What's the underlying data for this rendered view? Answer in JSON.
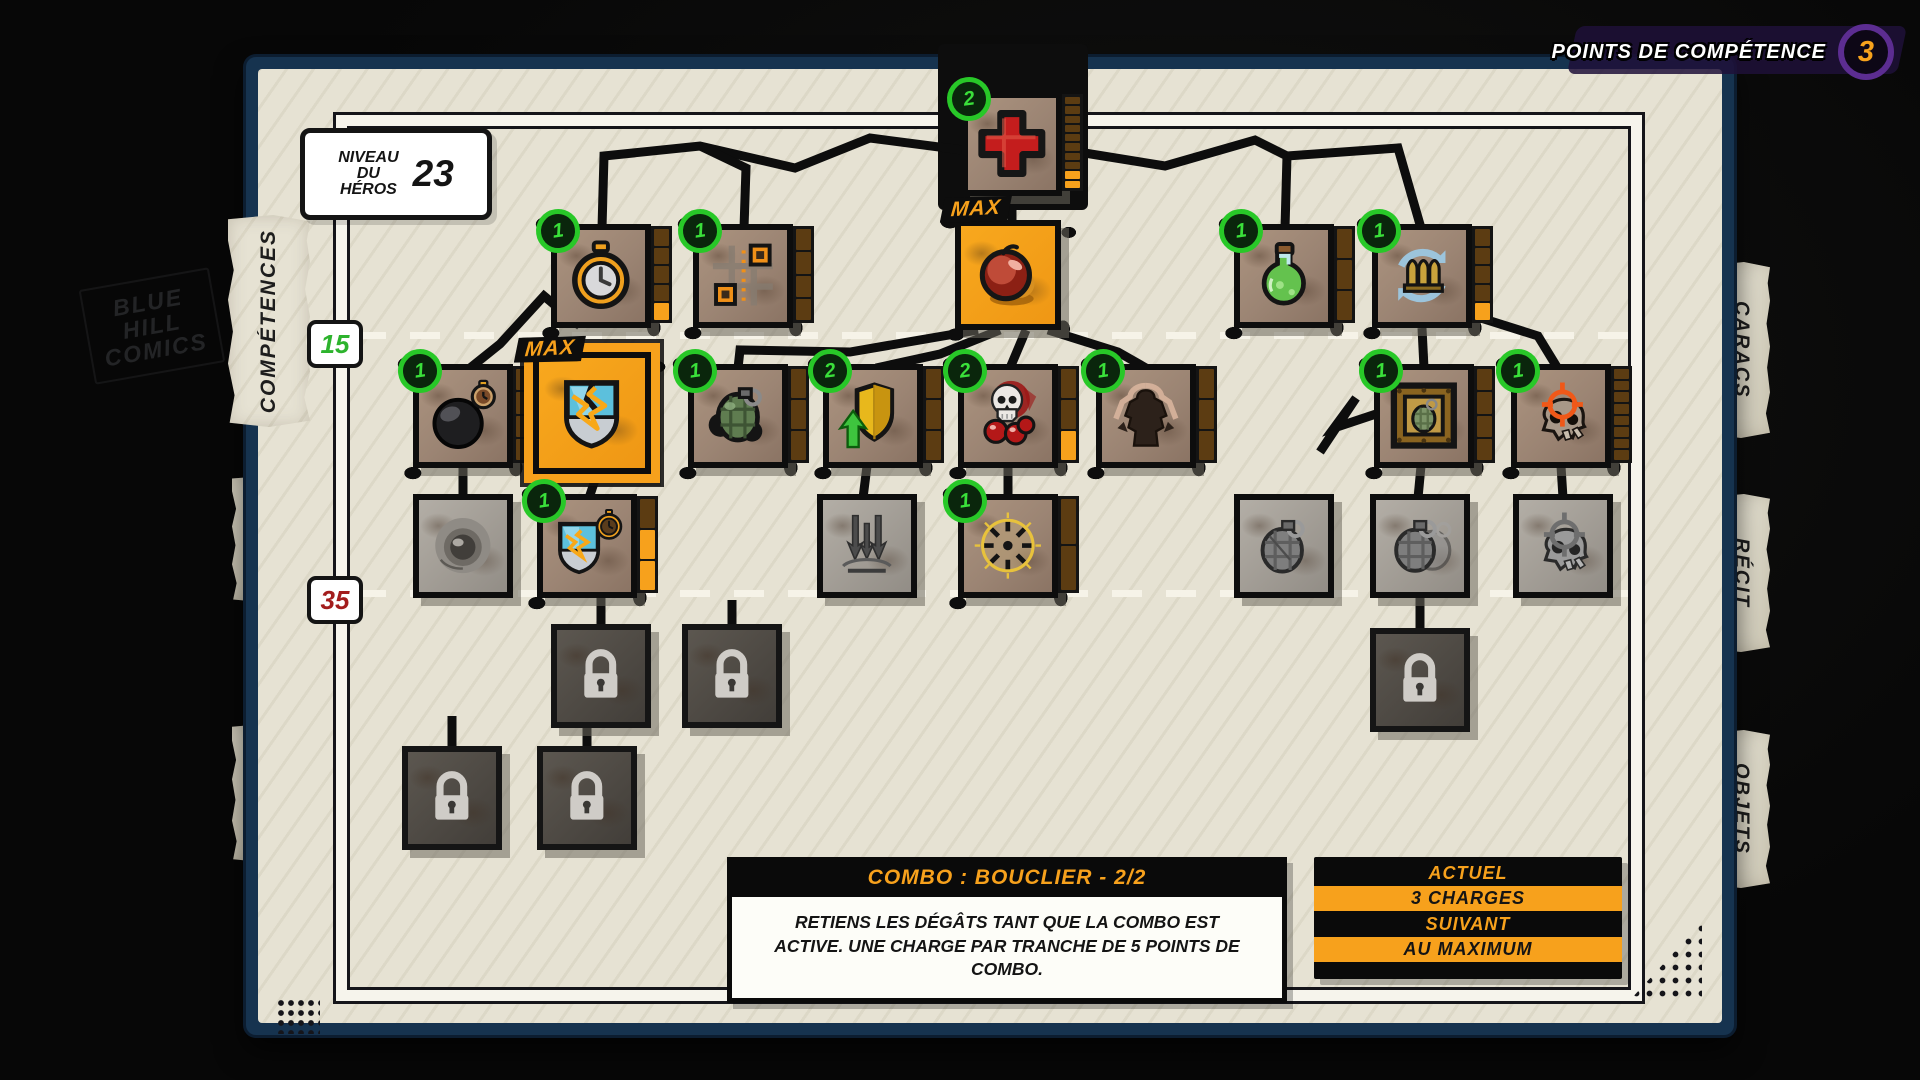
{
  "header": {
    "skill_points_label": "POINTS DE COMPÉTENCE",
    "skill_points_value": "3"
  },
  "hero_level": {
    "lines": [
      "NIVEAU",
      "DU",
      "HÉROS"
    ],
    "value": "23"
  },
  "background": {
    "logo_lines": [
      "BLUE",
      "HILL",
      "COMICS"
    ]
  },
  "labels": {
    "max": "MAX"
  },
  "tabs_left": [
    {
      "id": "competences",
      "label": "COMPÉTENCES",
      "active": true,
      "top": 215,
      "height": 212
    },
    {
      "id": "aspect",
      "label": "ASPECT",
      "active": false,
      "top": 476,
      "height": 126
    },
    {
      "id": "matos",
      "label": "MATOS",
      "active": false,
      "top": 724,
      "height": 138
    }
  ],
  "tabs_right": [
    {
      "id": "caracs",
      "label": "CARACS",
      "top": 262,
      "height": 176
    },
    {
      "id": "recit",
      "label": "RÉCIT",
      "top": 494,
      "height": 158
    },
    {
      "id": "objets",
      "label": "OBJETS",
      "top": 730,
      "height": 158
    }
  ],
  "level_markers": [
    {
      "value": "15",
      "color": "#2db32d",
      "line_y": 332,
      "box_y": 340
    },
    {
      "value": "35",
      "color": "#a31d1d",
      "line_y": 590,
      "box_y": 596
    }
  ],
  "tooltip": {
    "title": "COMBO : BOUCLIER - 2/2",
    "body": "RETIENS LES DÉGÂTS TANT QUE LA COMBO EST ACTIVE. UNE CHARGE PAR TRANCHE DE 5 POINTS DE COMBO."
  },
  "status_panel": {
    "rows": [
      {
        "text": "ACTUEL",
        "variant": "header"
      },
      {
        "text": "3 CHARGES",
        "variant": "value"
      },
      {
        "text": "SUIVANT",
        "variant": "header"
      },
      {
        "text": "AU MAXIMUM",
        "variant": "value"
      }
    ]
  },
  "colors": {
    "accent_orange": "#f7a11c",
    "badge_green": "#3ae03a",
    "points_purple": "#5c2d91",
    "panel_blue": "#16334f",
    "paper": "#e6e2d3"
  },
  "tree": {
    "nodes": [
      {
        "id": "heal",
        "icon": "heal-cross",
        "x": 962,
        "y": 92,
        "size": 100,
        "badge": "2",
        "strip": [
          10,
          2
        ]
      },
      {
        "id": "stopwatch",
        "icon": "stopwatch",
        "x": 551,
        "y": 224,
        "size": 100,
        "badge": "1",
        "strip": [
          5,
          1
        ]
      },
      {
        "id": "waypoint",
        "icon": "waypoint-path",
        "x": 693,
        "y": 224,
        "size": 100,
        "badge": "1",
        "strip": [
          4,
          0
        ]
      },
      {
        "id": "bomb-max",
        "icon": "bomb-red",
        "x": 955,
        "y": 220,
        "size": 106,
        "max": true
      },
      {
        "id": "potion",
        "icon": "potion",
        "x": 1234,
        "y": 224,
        "size": 100,
        "badge": "1",
        "strip": [
          3,
          0
        ]
      },
      {
        "id": "reload",
        "icon": "reload",
        "x": 1372,
        "y": 224,
        "size": 100,
        "badge": "1",
        "strip": [
          5,
          1
        ]
      },
      {
        "id": "black-bomb",
        "icon": "black-bomb",
        "x": 413,
        "y": 364,
        "size": 100,
        "badge": "1",
        "strip": [
          4,
          0
        ]
      },
      {
        "id": "shield-combo",
        "icon": "shield-combo",
        "x": 533,
        "y": 352,
        "size": 118,
        "max": true,
        "selected": true
      },
      {
        "id": "grenade",
        "icon": "grenade-green",
        "x": 688,
        "y": 364,
        "size": 100,
        "badge": "1",
        "strip": [
          3,
          0
        ]
      },
      {
        "id": "shield-upgrade",
        "icon": "shield-gold-arrow",
        "x": 823,
        "y": 364,
        "size": 100,
        "badge": "2",
        "strip": [
          3,
          0
        ]
      },
      {
        "id": "skull-bombs",
        "icon": "skull-bombs",
        "x": 958,
        "y": 364,
        "size": 100,
        "badge": "2",
        "strip": [
          3,
          1
        ]
      },
      {
        "id": "berserker",
        "icon": "berserker",
        "x": 1096,
        "y": 364,
        "size": 100,
        "badge": "1",
        "strip": [
          3,
          0
        ]
      },
      {
        "id": "crate-grenade",
        "icon": "crate-grenade",
        "x": 1374,
        "y": 364,
        "size": 100,
        "badge": "1",
        "strip": [
          4,
          0
        ]
      },
      {
        "id": "skull-crosshair",
        "icon": "skull-crosshair",
        "x": 1511,
        "y": 364,
        "size": 100,
        "badge": "1",
        "strip": [
          8,
          0
        ]
      },
      {
        "id": "gray-orb",
        "icon": "orb-gray",
        "x": 413,
        "y": 494,
        "size": 100,
        "disabled": true
      },
      {
        "id": "shield-timer",
        "icon": "shield-timer",
        "x": 537,
        "y": 494,
        "size": 100,
        "badge": "1",
        "strip": [
          3,
          2
        ]
      },
      {
        "id": "air-strike",
        "icon": "strike-gray",
        "x": 817,
        "y": 494,
        "size": 100,
        "disabled": true
      },
      {
        "id": "blade-wheel",
        "icon": "wheel-gold",
        "x": 958,
        "y": 494,
        "size": 100,
        "badge": "1",
        "strip": [
          2,
          0
        ]
      },
      {
        "id": "gray-grenade",
        "icon": "grenade-gray",
        "x": 1234,
        "y": 494,
        "size": 100,
        "disabled": true
      },
      {
        "id": "gray-double-grenade",
        "icon": "grenade2-gray",
        "x": 1370,
        "y": 494,
        "size": 100,
        "disabled": true
      },
      {
        "id": "gray-skull-crosshair",
        "icon": "skullcross-gray",
        "x": 1513,
        "y": 494,
        "size": 100,
        "disabled": true
      },
      {
        "id": "lock-1",
        "icon": "lock",
        "x": 551,
        "y": 624,
        "size": 100,
        "locked": true
      },
      {
        "id": "lock-2",
        "icon": "lock",
        "x": 682,
        "y": 624,
        "size": 100,
        "locked": true
      },
      {
        "id": "lock-3",
        "icon": "lock",
        "x": 1370,
        "y": 628,
        "size": 100,
        "locked": true
      },
      {
        "id": "lock-4",
        "icon": "lock",
        "x": 402,
        "y": 746,
        "size": 100,
        "locked": true
      },
      {
        "id": "lock-5",
        "icon": "lock",
        "x": 537,
        "y": 746,
        "size": 100,
        "locked": true
      }
    ],
    "connectors": [
      [
        [
          962,
          150
        ],
        [
          870,
          138
        ],
        [
          795,
          168
        ],
        [
          700,
          146
        ],
        [
          604,
          156
        ],
        [
          602,
          228
        ]
      ],
      [
        [
          700,
          146
        ],
        [
          746,
          168
        ],
        [
          744,
          228
        ]
      ],
      [
        [
          1012,
          196
        ],
        [
          1012,
          224
        ]
      ],
      [
        [
          1066,
          150
        ],
        [
          1165,
          166
        ],
        [
          1255,
          140
        ],
        [
          1287,
          156
        ],
        [
          1285,
          228
        ]
      ],
      [
        [
          1287,
          156
        ],
        [
          1398,
          148
        ],
        [
          1421,
          228
        ]
      ],
      [
        [
          1421,
          300
        ],
        [
          1480,
          268
        ],
        [
          1462,
          312
        ],
        [
          1538,
          336
        ],
        [
          1560,
          372
        ]
      ],
      [
        [
          978,
          330
        ],
        [
          850,
          352
        ],
        [
          740,
          350
        ],
        [
          738,
          368
        ]
      ],
      [
        [
          1000,
          330
        ],
        [
          940,
          354
        ],
        [
          876,
          368
        ]
      ],
      [
        [
          1026,
          330
        ],
        [
          1010,
          368
        ]
      ],
      [
        [
          1048,
          330
        ],
        [
          1118,
          352
        ],
        [
          1146,
          368
        ]
      ],
      [
        [
          580,
          326
        ],
        [
          544,
          296
        ],
        [
          500,
          344
        ],
        [
          470,
          368
        ]
      ],
      [
        [
          1320,
          452
        ],
        [
          1356,
          398
        ],
        [
          1334,
          428
        ],
        [
          1376,
          414
        ]
      ],
      [
        [
          1422,
          328
        ],
        [
          1424,
          368
        ]
      ],
      [
        [
          463,
          466
        ],
        [
          463,
          498
        ]
      ],
      [
        [
          597,
          474
        ],
        [
          589,
          498
        ]
      ],
      [
        [
          867,
          466
        ],
        [
          863,
          498
        ]
      ],
      [
        [
          1008,
          466
        ],
        [
          1008,
          498
        ]
      ],
      [
        [
          1421,
          466
        ],
        [
          1418,
          498
        ]
      ],
      [
        [
          1561,
          466
        ],
        [
          1563,
          498
        ]
      ],
      [
        [
          601,
          598
        ],
        [
          601,
          628
        ]
      ],
      [
        [
          732,
          600
        ],
        [
          732,
          628
        ]
      ],
      [
        [
          1420,
          596
        ],
        [
          1420,
          630
        ]
      ],
      [
        [
          452,
          716
        ],
        [
          452,
          748
        ]
      ],
      [
        [
          587,
          718
        ],
        [
          587,
          748
        ]
      ]
    ]
  }
}
